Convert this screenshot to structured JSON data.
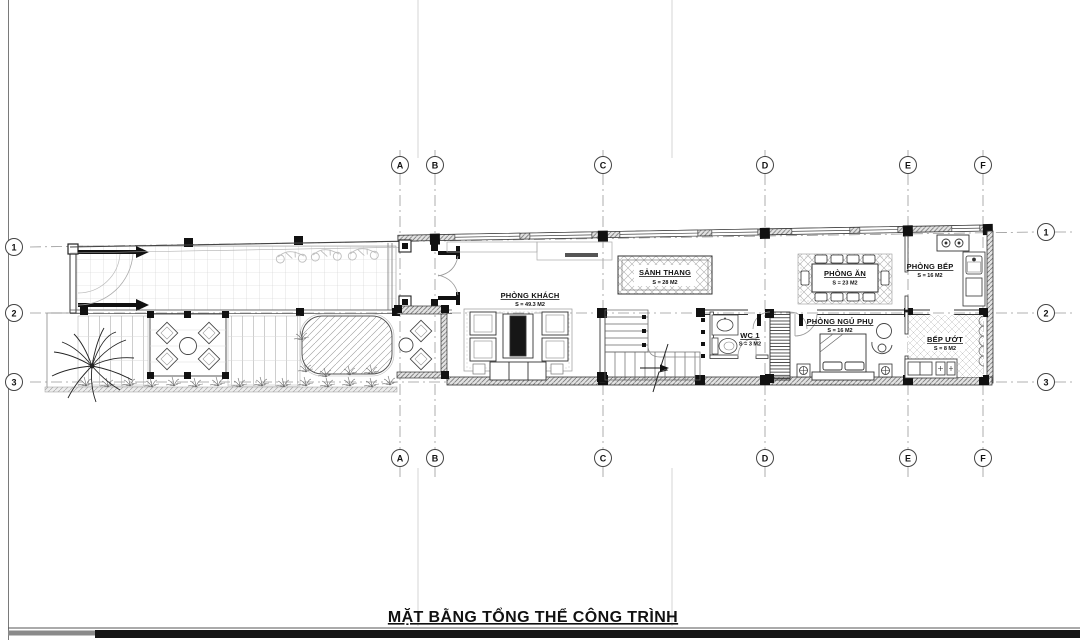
{
  "sheet": {
    "title": "MẶT BẰNG TỔNG THỂ CÔNG TRÌNH"
  },
  "grid": {
    "cols": [
      "A",
      "B",
      "C",
      "D",
      "E",
      "F"
    ],
    "rows": [
      "1",
      "2",
      "3"
    ]
  },
  "rooms": {
    "khach": {
      "name": "PHÒNG KHÁCH",
      "area": "S = 49.3 M2"
    },
    "sanh": {
      "name": "SẢNH THANG",
      "area": "S = 28 M2"
    },
    "an": {
      "name": "PHÒNG ĂN",
      "area": "S = 23 M2"
    },
    "bep": {
      "name": "PHÒNG BẾP",
      "area": "S = 16 M2"
    },
    "wc": {
      "name": "WC 1",
      "area": "S = 3 M2"
    },
    "ngu": {
      "name": "PHÒNG NGỦ PHỤ",
      "area": "S = 16 M2"
    },
    "bepuot": {
      "name": "BẾP ƯỚT",
      "area": "S = 8 M2"
    }
  },
  "colors": {
    "ink": "#1a1a1a",
    "wall": "#333333",
    "gridline": "#999999"
  }
}
